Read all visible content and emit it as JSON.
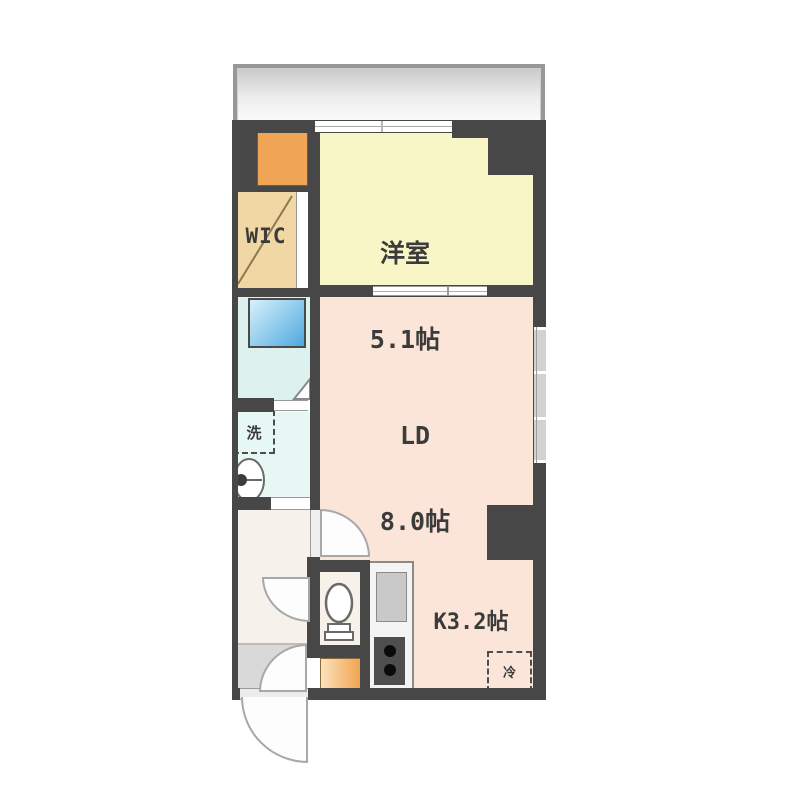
{
  "plan_type": "apartment-floor-plan",
  "rooms": {
    "western": {
      "name": "洋室",
      "size": "5.1帖"
    },
    "ld": {
      "name": "LD",
      "size": "8.0帖"
    },
    "kitchen": {
      "label": "K3.2帖"
    },
    "wic": {
      "label": "WIC"
    }
  },
  "fixtures": {
    "laundry_space": "洗",
    "refrigerator_space": "冷"
  },
  "colors": {
    "wall": "#474747",
    "western_room_floor": "#f8f6c6",
    "living_dining_floor": "#fbe5d8",
    "wic_floor": "#f1d7a4",
    "closet_orange": "#f0a455",
    "bathroom_floor": "#ddf2ee",
    "washroom_floor": "#e7f8f4",
    "bathtub_blue": "#5aaede",
    "hall_floor": "#f6f1ea",
    "entrance_floor": "#d9d9d9",
    "balcony_gray": "#d6d6d6"
  }
}
